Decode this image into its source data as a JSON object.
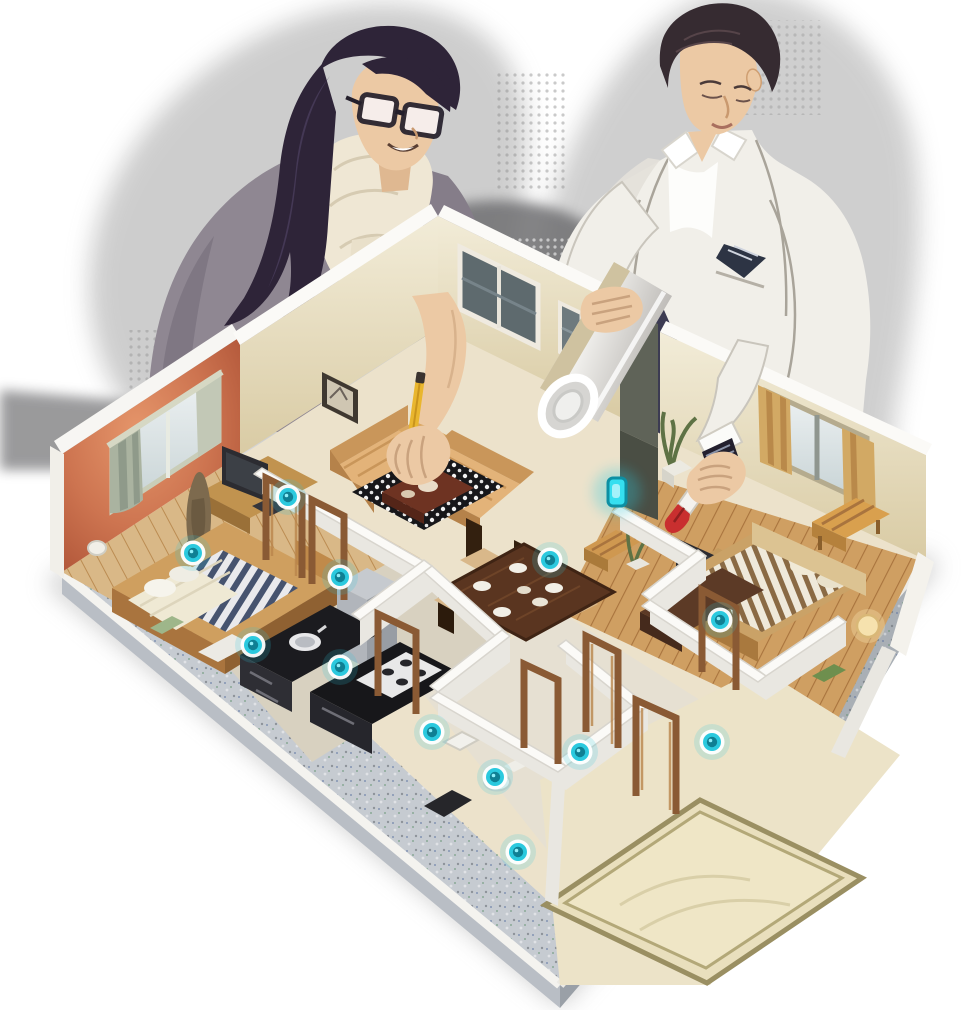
{
  "meta": {
    "kind": "stylized-illustration",
    "subject": "woman designer and man architect reviewing an isometric 3D smart-home floor plan model",
    "visible_text": []
  },
  "palette": {
    "accent": "#2bc9de",
    "accentDeep": "#0f7f93",
    "accentGlow": "#8feef9",
    "haloGray": "#9c9c9c",
    "haloDark": "#6f6f72",
    "wallWhite": "#f7f5f0",
    "wallWarm": "#e7dcba",
    "orangeWall": "#c96b45",
    "floorCream": "#ece2cb",
    "woodLight": "#d3a465",
    "woodMid": "#a9743e",
    "woodDark": "#6b3a22",
    "counterDark": "#1d1d22",
    "platformGray": "#b9bec5",
    "platformDeep": "#9aa0a7",
    "skin": "#ecc9a4",
    "hairWoman": "#2e2438",
    "hairMan": "#362b31",
    "suitWhite": "#f1efe9",
    "navyDark": "#31304a",
    "scarfCream": "#efe7d4",
    "topGray": "#8f8792",
    "penRed": "#c92f2f",
    "pencilYellow": "#e9b62e",
    "curtainGreen": "#aab3a0",
    "curtainTan": "#d2a964",
    "bedStripe": "#46536f",
    "glassCool": "#5e6a6e"
  },
  "people": [
    {
      "id": "woman-designer",
      "features": [
        "dark-hair",
        "glasses",
        "cream-scarf",
        "gray-top",
        "yellow-pencil-in-hand"
      ]
    },
    {
      "id": "man-architect",
      "features": [
        "white-suit",
        "pocket-square",
        "wristwatch",
        "rolled-blueprint-under-arm",
        "red-capped-pen-in-hand"
      ]
    }
  ],
  "floor_plan": {
    "rooms": [
      "left-bedroom-orange-wall",
      "living-room",
      "dining-area",
      "kitchen",
      "bathrooms",
      "right-bedroom",
      "rug-room"
    ],
    "furniture": [
      "bed-striped-left",
      "desk-with-monitor",
      "statue",
      "sofa-pair",
      "coffee-table-on-bw-rug",
      "dining-table-six-plates",
      "five-chairs",
      "potted-plants",
      "wood-bench",
      "stool",
      "gray-wardrobe",
      "kitchen-counters-with-stove-and-sink",
      "toilet",
      "washbasin",
      "bed-striped-right",
      "foot-bench",
      "headboard-shelf",
      "tv-on-desk",
      "bedside-lamp",
      "large-bordered-rug"
    ]
  },
  "sensors": {
    "count": 12,
    "style": "glowing cyan round smart-home sensor",
    "points": [
      [
        288,
        497
      ],
      [
        193,
        553
      ],
      [
        253,
        645
      ],
      [
        340,
        577
      ],
      [
        550,
        560
      ],
      [
        340,
        667
      ],
      [
        432,
        732
      ],
      [
        495,
        777
      ],
      [
        518,
        852
      ],
      [
        580,
        752
      ],
      [
        712,
        742
      ],
      [
        720,
        620
      ]
    ],
    "wall_sensor": {
      "x": 608,
      "y": 478,
      "w": 18,
      "h": 28
    }
  }
}
